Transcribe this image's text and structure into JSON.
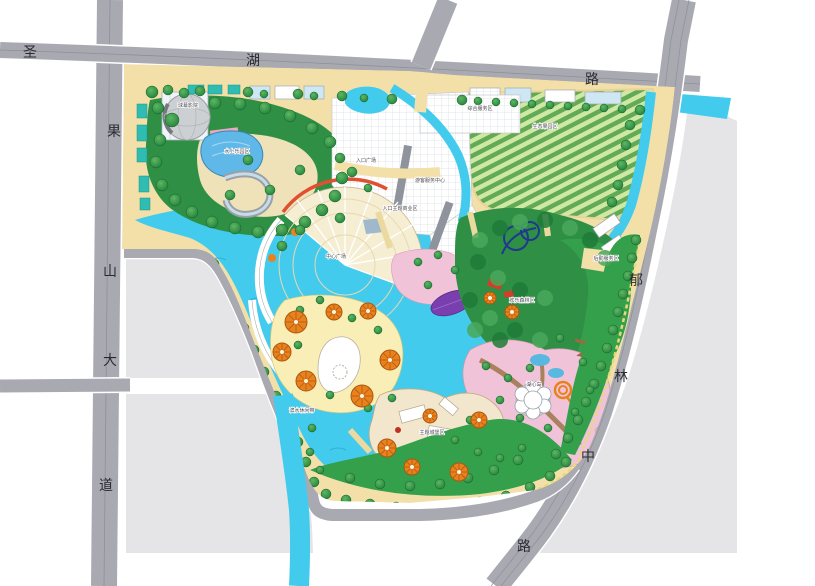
{
  "map": {
    "kind": "theme-park-master-plan",
    "roads": {
      "west": {
        "name": "圣果山大道",
        "chars": [
          [
            "圣",
            30,
            57
          ],
          [
            "果",
            114,
            136
          ],
          [
            "山",
            110,
            276
          ],
          [
            "大",
            110,
            365
          ],
          [
            "道",
            106,
            490
          ]
        ]
      },
      "north": {
        "name": "湖路",
        "chars": [
          [
            "湖",
            253,
            65
          ],
          [
            "路",
            592,
            84
          ]
        ]
      },
      "east": {
        "name": "郁林中路",
        "chars": [
          [
            "郁",
            636,
            285
          ],
          [
            "林",
            621,
            381
          ],
          [
            "中",
            588,
            461
          ],
          [
            "路",
            524,
            551
          ]
        ]
      }
    },
    "site_labels": [
      [
        "水上乐园区",
        237,
        153
      ],
      [
        "球幕影院",
        188,
        107
      ],
      [
        "入口主题商业区",
        400,
        210
      ],
      [
        "游客服务中心",
        430,
        182
      ],
      [
        "生态果园区",
        545,
        128
      ],
      [
        "入口广场",
        366,
        162
      ],
      [
        "综合服务区",
        480,
        110
      ],
      [
        "中心广场",
        336,
        258
      ],
      [
        "欢乐森林区",
        522,
        302
      ],
      [
        "后勤服务区",
        606,
        260
      ],
      [
        "湖心岛",
        534,
        386
      ],
      [
        "主题城堡区",
        432,
        434
      ],
      [
        "滨水休闲带",
        302,
        412
      ]
    ],
    "colors": {
      "road": "#a9a9b2",
      "parcel": "#e5e5e8",
      "water": "#43cbee",
      "park_base": "#f3e0a9",
      "forest": "#2e8f45",
      "lawn": "#35a04c",
      "orchard": "#cfe9a4",
      "plaza": "#f6eed2",
      "pink": "#f0c3d8",
      "yellow": "#f9efb6",
      "orange_ride": "#e8821e",
      "accent_red": "#e05030",
      "purple": "#7a3fae"
    }
  }
}
